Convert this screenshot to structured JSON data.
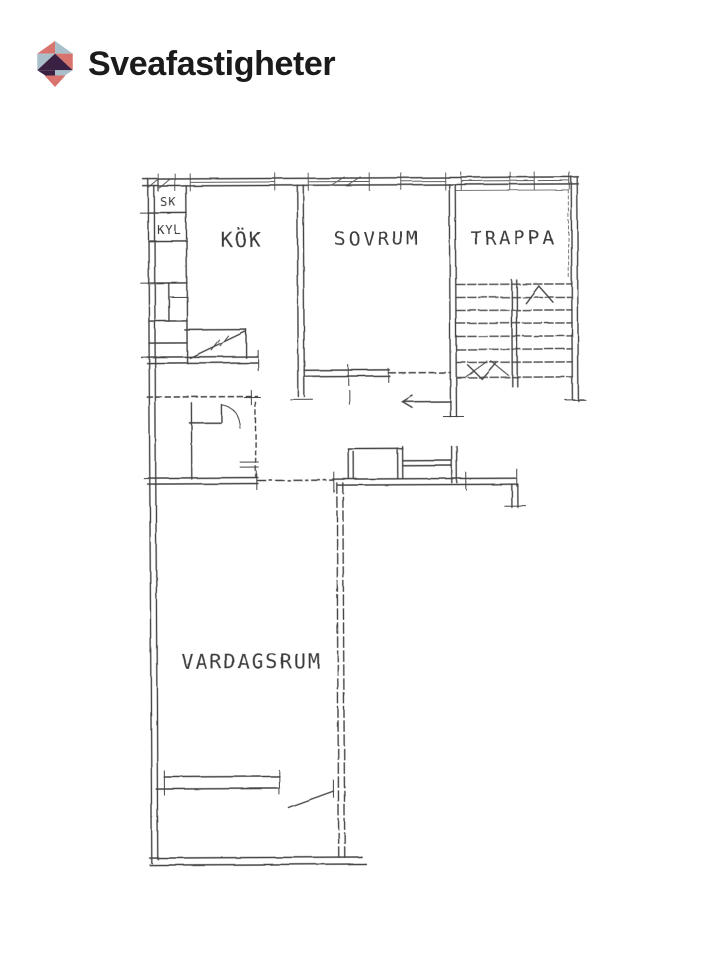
{
  "brand": {
    "name": "Sveafastigheter",
    "logo_icon": "triangle-house-logo",
    "colors": {
      "coral": "#d8736d",
      "slate": "#a9bfca",
      "plum": "#3a2144",
      "text": "#1b1b1b"
    }
  },
  "floorplan": {
    "type": "apartment-floor-plan-scan",
    "ink_color": "#454545",
    "background": "#ffffff",
    "room_labels": {
      "kok": "KÖK",
      "sovrum": "SOVRUM",
      "trappa": "TRAPPA",
      "vardagsrum": "VARDAGSRUM",
      "closet_sk": "SK",
      "fridge_kyl": "KYL"
    }
  }
}
